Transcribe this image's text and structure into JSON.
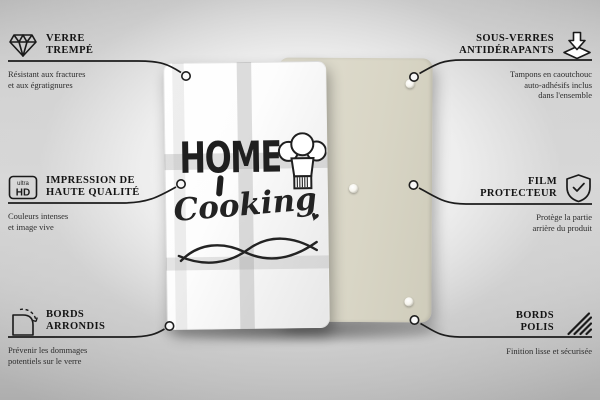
{
  "product_front": {
    "word1": "HOME",
    "word2": "Cooking",
    "heart": "♥"
  },
  "callouts_left": [
    {
      "icon": "diamond-icon",
      "title1": "VERRE",
      "title2": "TREMPÉ",
      "desc1": "Résistant aux fractures",
      "desc2": "et aux égratignures"
    },
    {
      "icon": "ultra-hd-icon",
      "icon_text_top": "ultra",
      "icon_text_bottom": "HD",
      "title1": "IMPRESSION DE",
      "title2": "HAUTE QUALITÉ",
      "desc1": "Couleurs intenses",
      "desc2": "et image vive"
    },
    {
      "icon": "rounded-corner-icon",
      "title1": "BORDS",
      "title2": "ARRONDIS",
      "desc1": "Prévenir les dommages",
      "desc2": "potentiels sur le verre"
    }
  ],
  "callouts_right": [
    {
      "icon": "non-slip-pad-icon",
      "title1": "SOUS-VERRES",
      "title2": "ANTIDÉRAPANTS",
      "desc1": "Tampons en caoutchouc",
      "desc2": "auto-adhésifs inclus",
      "desc3": "dans l'ensemble"
    },
    {
      "icon": "shield-check-icon",
      "title1": "FILM",
      "title2": "PROTECTEUR",
      "desc1": "Protège la partie",
      "desc2": "arrière du produit"
    },
    {
      "icon": "polished-edge-icon",
      "title1": "BORDS",
      "title2": "POLIS",
      "desc1": "Finition lisse et sécurisée"
    }
  ],
  "colors": {
    "line": "#1d1d1d",
    "title_text": "#141414",
    "subtitle_text": "#2d2d2d",
    "back_panel": "#d9d6c6",
    "glass_panel": "#ffffff",
    "background_edge": "#aeaeae"
  }
}
